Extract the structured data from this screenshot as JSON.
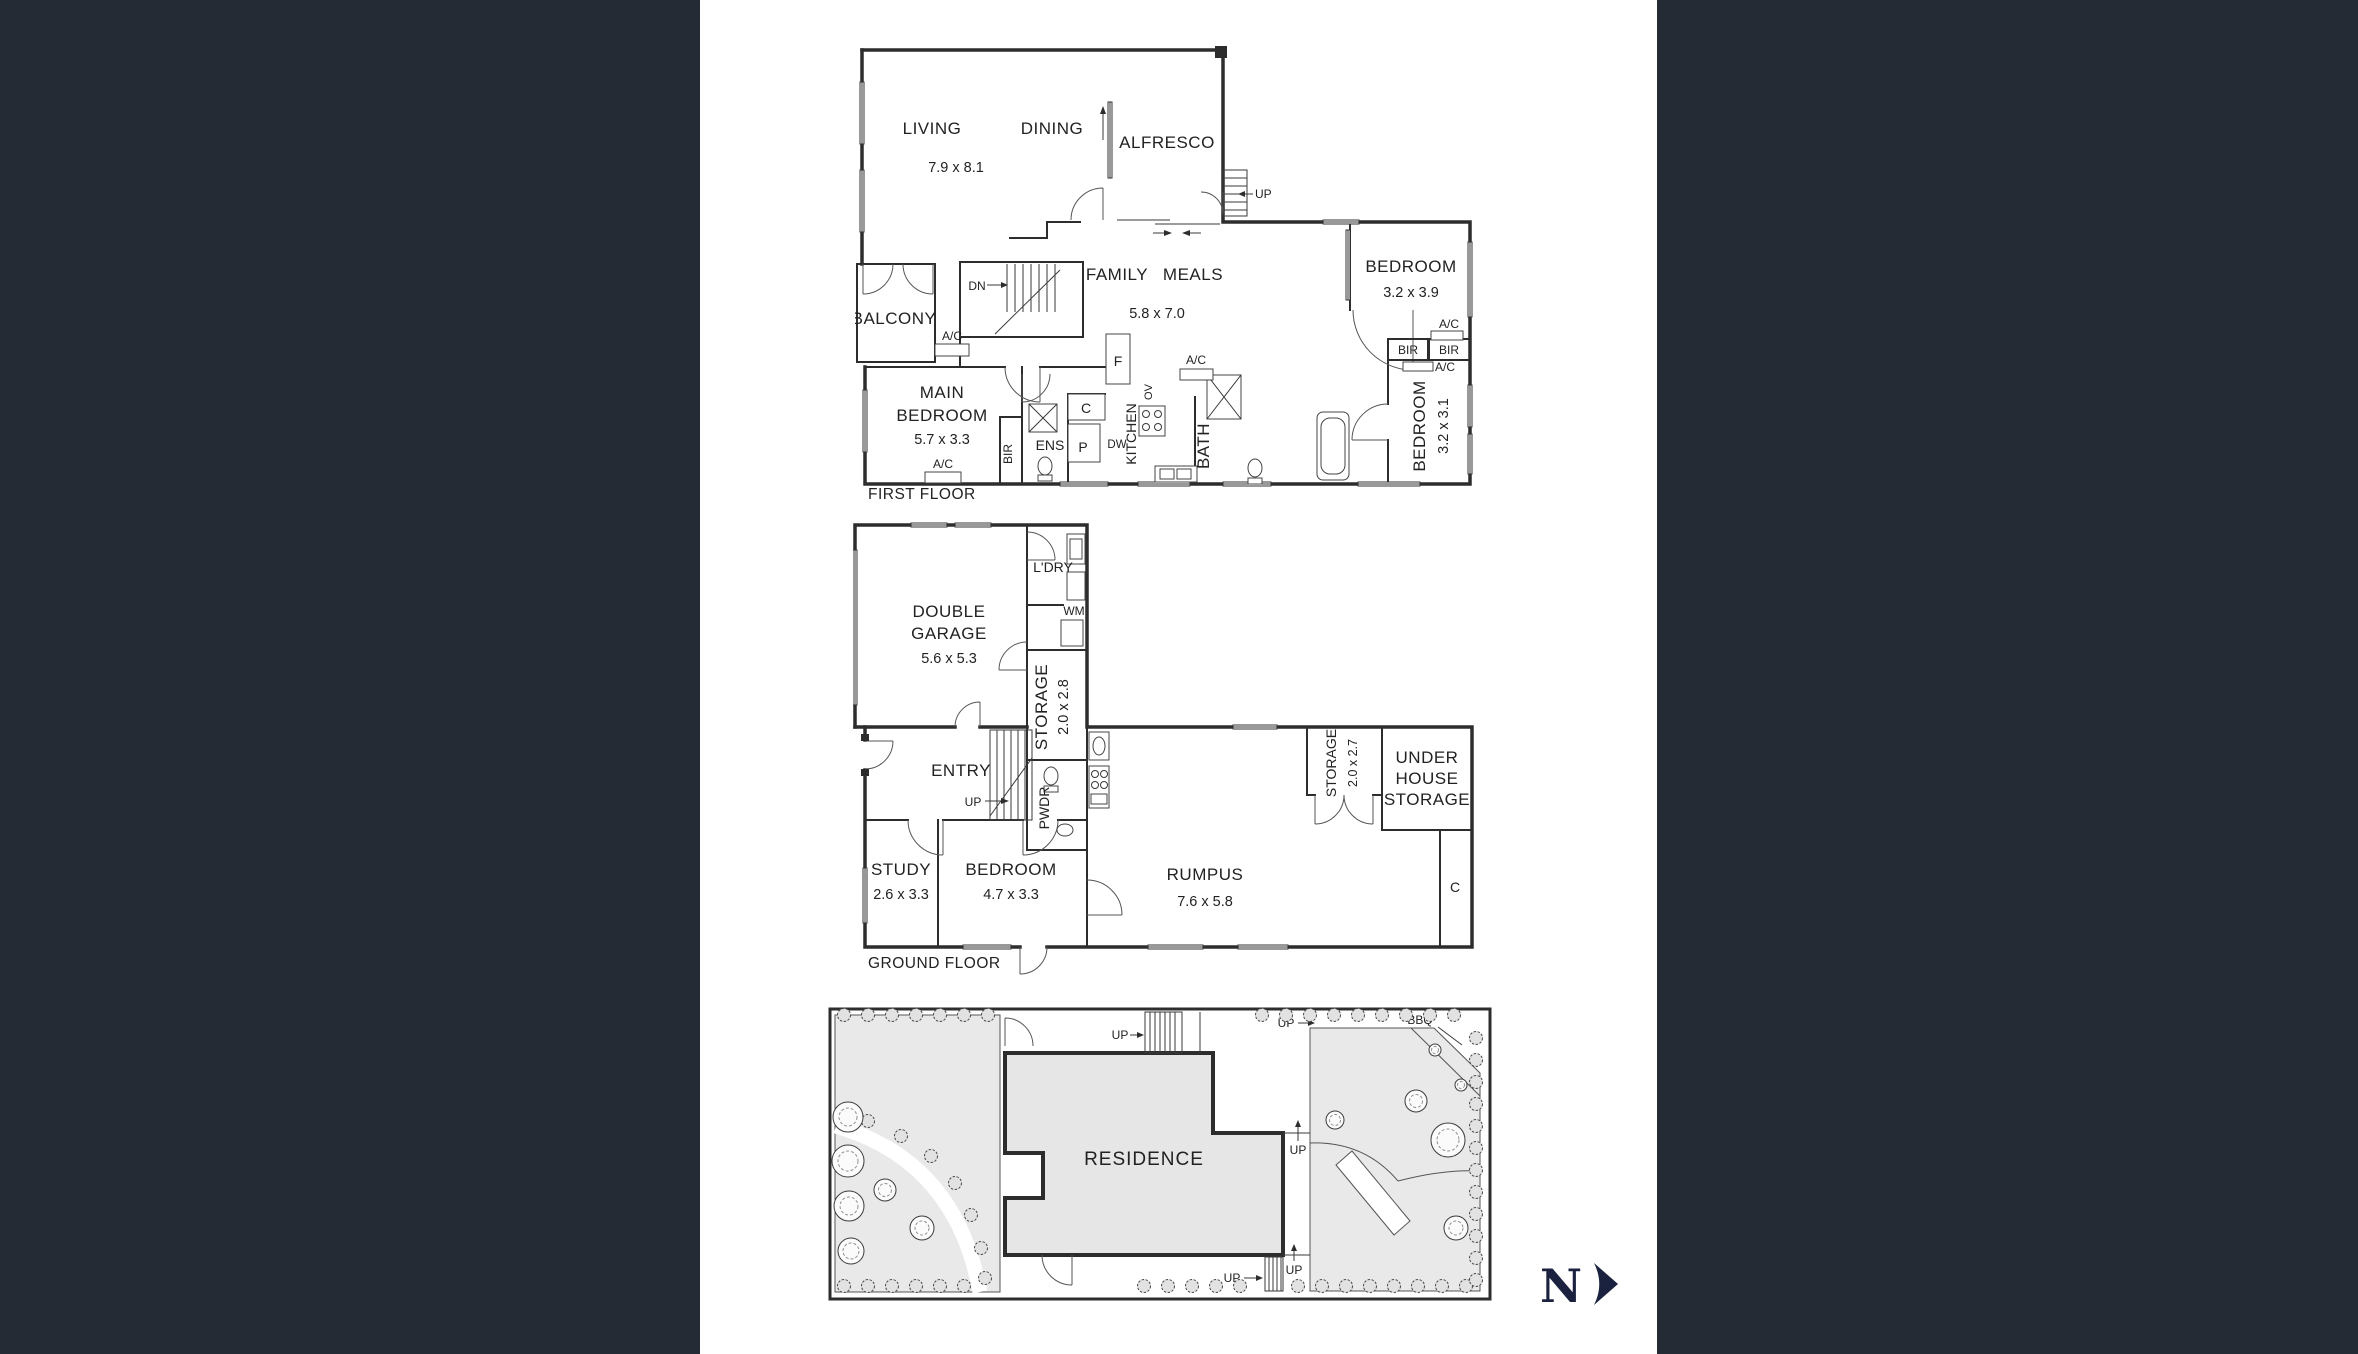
{
  "colors": {
    "sidebar": "#252b35",
    "wall": "#2d2d2d",
    "garden_fill": "#e9e9e9",
    "residence_fill": "#e6e6e6",
    "compass": "#1b2240"
  },
  "first_floor": {
    "floor_label": "FIRST FLOOR",
    "living": "LIVING",
    "living_dims": "7.9 x 8.1",
    "dining": "DINING",
    "alfresco": "ALFRESCO",
    "up": "UP",
    "dn": "DN",
    "family": "FAMILY",
    "meals": "MEALS",
    "family_dims": "5.8 x 7.0",
    "bedroom2": "BEDROOM",
    "bedroom2_dims": "3.2 x 3.9",
    "balcony": "BALCONY",
    "ac": "A/C",
    "main_bedroom_l1": "MAIN",
    "main_bedroom_l2": "BEDROOM",
    "main_bedroom_dims": "5.7 x 3.3",
    "bir": "BIR",
    "ens": "ENS",
    "cupboard": "C",
    "pantry": "P",
    "fridge": "F",
    "kitchen": "KITCHEN",
    "oven": "OV",
    "dishwasher": "DW",
    "bath": "BATH",
    "bedroom3": "BEDROOM",
    "bedroom3_dims": "3.2 x 3.1"
  },
  "ground_floor": {
    "floor_label": "GROUND FLOOR",
    "garage_l1": "DOUBLE",
    "garage_l2": "GARAGE",
    "garage_dims": "5.6 x 5.3",
    "laundry": "L'DRY",
    "wm": "WM",
    "storage1": "STORAGE",
    "storage1_dims": "2.0 x 2.8",
    "entry": "ENTRY",
    "up": "UP",
    "pwdr": "PWDR",
    "storage2": "STORAGE",
    "storage2_dims": "2.0 x 2.7",
    "uhs_l1": "UNDER",
    "uhs_l2": "HOUSE",
    "uhs_l3": "STORAGE",
    "study": "STUDY",
    "study_dims": "2.6 x 3.3",
    "bedroom": "BEDROOM",
    "bedroom_dims": "4.7 x 3.3",
    "rumpus": "RUMPUS",
    "rumpus_dims": "7.6 x 5.8",
    "cupboard": "C"
  },
  "site_plan": {
    "residence": "RESIDENCE",
    "bbq": "BBQ",
    "up": "UP",
    "north": "N"
  }
}
